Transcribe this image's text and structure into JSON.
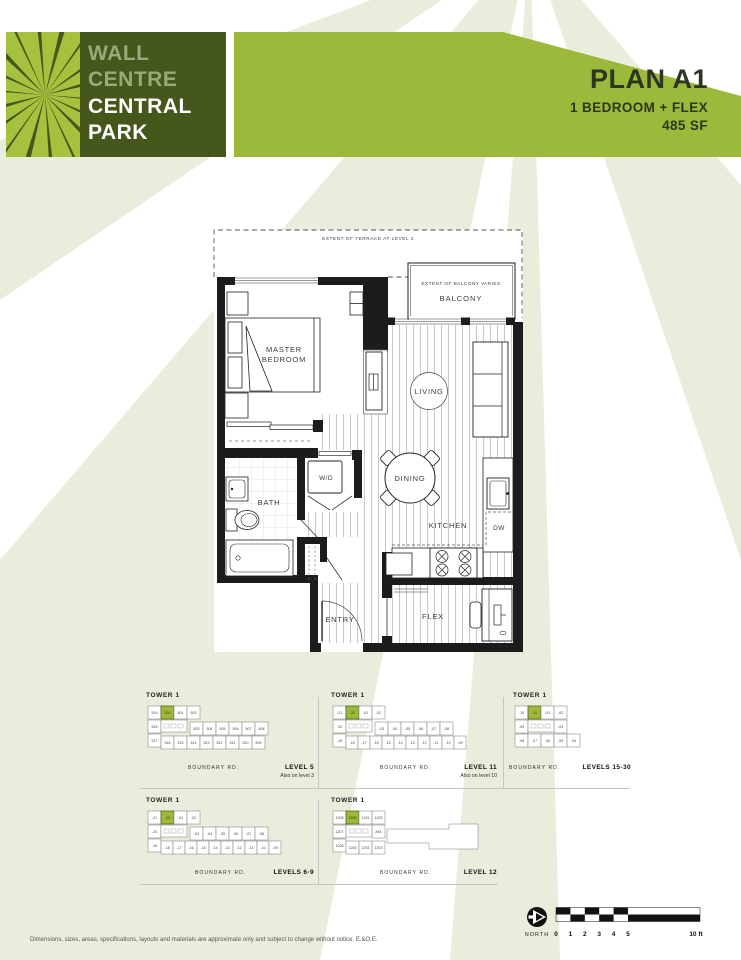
{
  "colors": {
    "accent_green": "#9cb93c",
    "dark_green": "#46571c",
    "ray_green": "#a6c13d",
    "pale_band": "#e9eddc",
    "sage_text": "#9aa97c",
    "wall_black": "#1c1c1c"
  },
  "header": {
    "logo": {
      "line1": "WALL",
      "line2": "CENTRE",
      "line3": "CENTRAL",
      "line4": "PARK"
    },
    "plan_title": "PLAN A1",
    "plan_subtitle": "1 BEDROOM + FLEX",
    "plan_area": "485 SF"
  },
  "floorplan": {
    "labels": {
      "terrace": "EXTENT OF TERRACE AT LEVEL 3",
      "balcony_extent": "EXTENT OF BALCONY VARIES",
      "balcony": "BALCONY",
      "master_line1": "MASTER",
      "master_line2": "BEDROOM",
      "living": "LIVING",
      "dining": "DINING",
      "kitchen": "KITCHEN",
      "dishwasher": "DW",
      "bath": "BATH",
      "washer_dryer": "W/D",
      "entry": "ENTRY",
      "flex": "FLEX"
    }
  },
  "keyplans": [
    {
      "tower": "TOWER 1",
      "road": "BOUNDARY RD.",
      "level": "LEVEL 5",
      "note": "Also on level 3",
      "highlight_index": 1,
      "units": [
        "519",
        "520",
        "501",
        "502",
        "518",
        "503",
        "504",
        "505",
        "506",
        "507",
        "508",
        "517",
        "516",
        "515",
        "514",
        "513",
        "512",
        "511",
        "510",
        "509"
      ]
    },
    {
      "tower": "TOWER 1",
      "road": "BOUNDARY RD.",
      "level": "LEVEL 11",
      "note": "Also on level 10",
      "highlight_index": 1,
      "units": [
        "-21",
        "-22",
        "-01",
        "-02",
        "-20",
        "-03",
        "-04",
        "-05",
        "-06",
        "-07",
        "-08",
        "-19",
        "-18",
        "-17",
        "-16",
        "-15",
        "-14",
        "-13",
        "-12",
        "-11",
        "-10",
        "-09"
      ]
    },
    {
      "tower": "TOWER 1",
      "road": "BOUNDARY RD.",
      "level": "LEVELS 15-30",
      "note": "",
      "highlight_index": 1,
      "units": [
        "-10",
        "-11",
        "-01",
        "-02",
        "-09",
        "-03",
        "-08",
        "-07",
        "-06",
        "-05",
        "-04"
      ]
    },
    {
      "tower": "TOWER 1",
      "road": "BOUNDARY RD.",
      "level": "LEVELS 6-9",
      "note": "",
      "highlight_index": 1,
      "units": [
        "-21",
        "-22",
        "-01",
        "-02",
        "-20",
        "-03",
        "-04",
        "-05",
        "-06",
        "-07",
        "-08",
        "-19",
        "-18",
        "-17",
        "-16",
        "-15",
        "-14",
        "-13",
        "-12",
        "-11",
        "-10",
        "-09"
      ]
    },
    {
      "tower": "TOWER 1",
      "road": "BOUNDARY RD.",
      "level": "LEVEL 12",
      "note": "",
      "highlight_index": 1,
      "units": [
        "1208",
        "1209",
        "1201",
        "1202",
        "1207",
        "1206",
        "AM.",
        "1205",
        "1204",
        "1203"
      ]
    }
  ],
  "footer": {
    "disclaimer": "Dimensions, sizes, areas, specifications, layouts and materials are approximate only and subject to change without notice. E.&O.E.",
    "north_label": "NORTH",
    "scale_ticks": [
      "0",
      "1",
      "2",
      "3",
      "4",
      "5"
    ],
    "scale_end": "10 ft"
  }
}
